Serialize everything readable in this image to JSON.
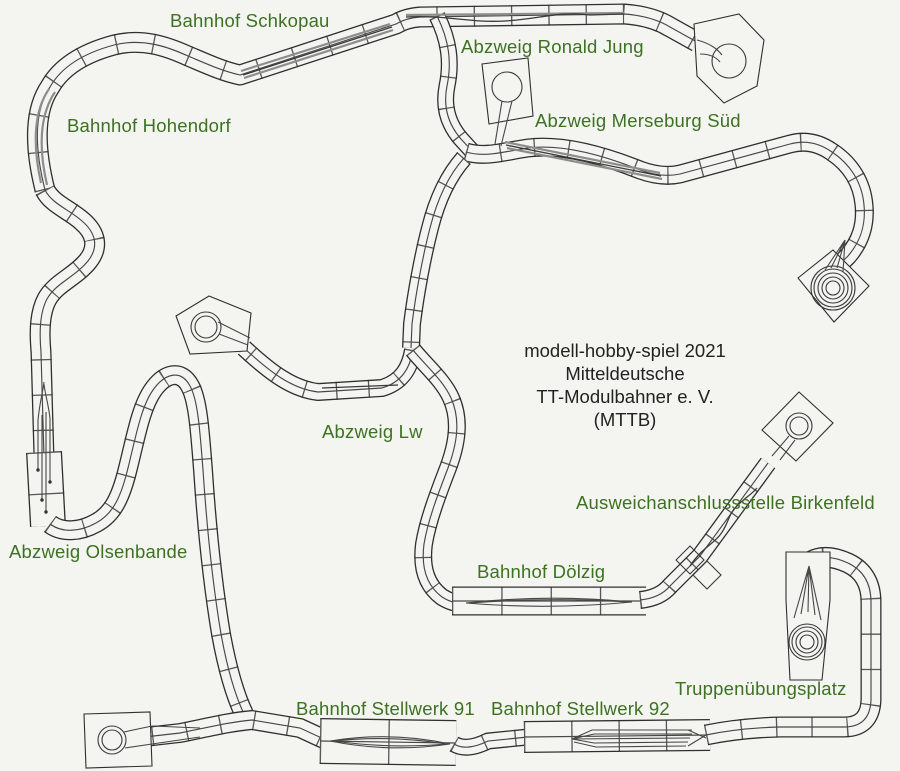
{
  "diagram": {
    "kind": "model-railway module track plan",
    "colors": {
      "background": "#f4f4f0",
      "label_green": "#3d7222",
      "title_black": "#222222",
      "line": "#2f2f2f"
    },
    "title": {
      "line1": "modell-hobby-spiel 2021",
      "line2": "Mitteldeutsche",
      "line3": "TT-Modulbahner e. V.",
      "line4": "(MTTB)"
    },
    "labels": {
      "schkopau": "Bahnhof Schkopau",
      "ronald_jung": "Abzweig Ronald Jung",
      "merseburg": "Abzweig Merseburg Süd",
      "hohendorf": "Bahnhof Hohendorf",
      "lw": "Abzweig Lw",
      "birkenfeld": "Ausweichanschlussstelle Birkenfeld",
      "olsenbande": "Abzweig Olsenbande",
      "dolzig": "Bahnhof Dölzig",
      "truppenuebungsplatz": "Truppenübungsplatz",
      "stellwerk91": "Bahnhof Stellwerk 91",
      "stellwerk92": "Bahnhof Stellwerk 92"
    }
  }
}
